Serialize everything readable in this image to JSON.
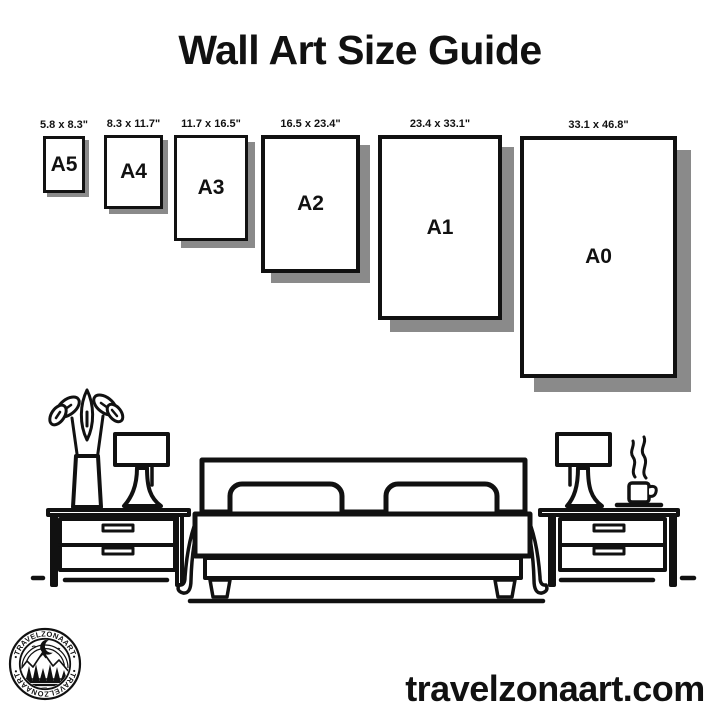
{
  "title": "Wall Art Size Guide",
  "frames": [
    {
      "name": "A5",
      "size": "5.8 x 8.3\""
    },
    {
      "name": "A4",
      "size": "8.3 x 11.7\""
    },
    {
      "name": "A3",
      "size": "11.7 x 16.5\""
    },
    {
      "name": "A2",
      "size": "16.5 x 23.4\""
    },
    {
      "name": "A1",
      "size": "23.4 x 33.1\""
    },
    {
      "name": "A0",
      "size": "33.1 x 46.8\""
    }
  ],
  "logo": {
    "brand": "TRAVELZONAART",
    "ring_text": "•TRAVELZONAART•"
  },
  "website": "travelzonaart.com",
  "colors": {
    "ink": "#111111",
    "shadow": "#8a8a8a",
    "background": "#ffffff"
  },
  "scene_icons": [
    "plant-vase-icon",
    "table-lamp-icon",
    "nightstand-icon",
    "double-bed-icon",
    "pillow-icon",
    "coffee-cup-icon",
    "floor-line-icon"
  ]
}
